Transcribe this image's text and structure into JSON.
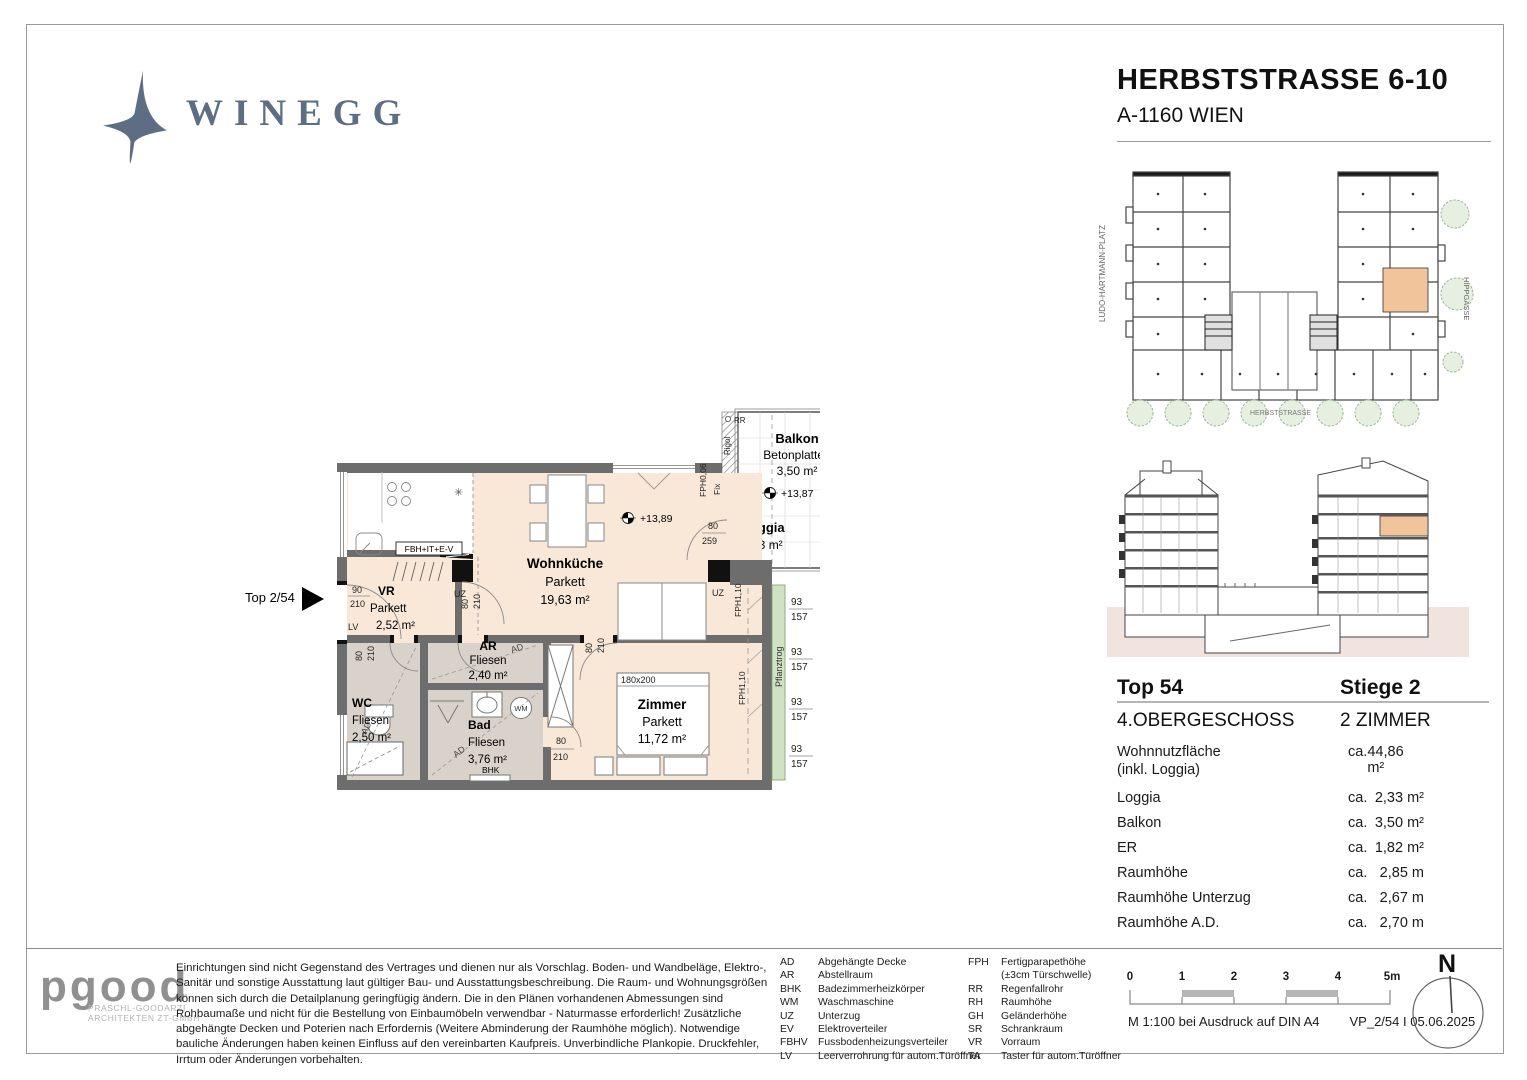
{
  "page": {
    "brand": "WINEGG",
    "title": "HERBSTSTRASSE 6-10",
    "subtitle": "A-1160 WIEN"
  },
  "floorplan": {
    "unit_arrow": "Top 2/54",
    "rooms": {
      "vr": {
        "name": "VR",
        "floor": "Parkett",
        "area": "2,52 m²"
      },
      "wohnkueche": {
        "name": "Wohnküche",
        "floor": "Parkett",
        "area": "19,63 m²"
      },
      "wc": {
        "name": "WC",
        "floor": "Fliesen",
        "area": "2,50 m²"
      },
      "ar": {
        "name": "AR",
        "floor": "Fliesen",
        "area": "2,40 m²"
      },
      "bad": {
        "name": "Bad",
        "floor": "Fliesen",
        "area": "3,76 m²"
      },
      "zimmer": {
        "name": "Zimmer",
        "floor": "Parkett",
        "area": "11,72 m²",
        "bed": "180x200"
      },
      "balkon": {
        "name": "Balkon",
        "floor": "Betonplatten",
        "area": "3,50 m²"
      },
      "loggia": {
        "name": "Loggia",
        "area": "2,33 m²"
      }
    },
    "annotations": {
      "fbh": "FBH+IT+E-V",
      "uz": "UZ",
      "lv": "LV",
      "wm": "WM",
      "bhk": "BHK",
      "ad": "AD",
      "rr": "RR",
      "rigol": "Rigol",
      "fix": "Fix",
      "fph0": "FPH0,06",
      "fph1": "FPH1,10",
      "gh": "GH= 112",
      "pflanztrog": "Pflanztrog",
      "elev_inside": "+13,89",
      "elev_balcony": "+13,87"
    },
    "dims": {
      "d75": "75",
      "d80": "80",
      "d90": "90",
      "d93": "93",
      "d157": "157",
      "d210": "210",
      "d259": "259",
      "d268": "268"
    }
  },
  "siteplan": {
    "street_left": "LUDO-HARTMANN-PLATZ",
    "street_bottom": "HERBSTSTRASSE",
    "street_right": "HIPPGASSE"
  },
  "unit_info": {
    "unit": "Top 54",
    "stair": "Stiege 2",
    "level": "4.OBERGESCHOSS",
    "room_count": "2 ZIMMER",
    "rows": [
      {
        "label": "Wohnnutzfläche",
        "sublabel": "(inkl. Loggia)",
        "ca": "ca.",
        "value": "44,86 m²"
      },
      {
        "label": "Loggia",
        "ca": "ca.",
        "value": "2,33 m²"
      },
      {
        "label": "Balkon",
        "ca": "ca.",
        "value": "3,50 m²"
      },
      {
        "label": "ER",
        "ca": "ca.",
        "value": "1,82 m²"
      },
      {
        "label": "Raumhöhe",
        "ca": "ca.",
        "value": "2,85 m"
      },
      {
        "label": "Raumhöhe Unterzug",
        "ca": "ca.",
        "value": "2,67 m"
      },
      {
        "label": "Raumhöhe A.D.",
        "ca": "ca.",
        "value": "2,70 m"
      }
    ]
  },
  "footer": {
    "architect": {
      "wordmark": "pgood",
      "sub1": "PRASCHL-GOODARZI",
      "sub2": "ARCHITEKTEN ZT-GMBH"
    },
    "disclaimer": "Einrichtungen sind nicht Gegenstand des Vertrages und dienen nur als Vorschlag. Boden- und Wandbeläge, Elektro-, Sanitär und sonstige Ausstattung laut gültiger Bau- und Ausstattungsbeschreibung. Die Raum- und Wohnungsgrößen können sich durch die Detailplanung geringfügig ändern. Die in den Plänen vorhandenen Abmessungen sind Rohbaumaße und nicht für die Bestellung von Einbaumöbeln verwendbar - Naturmasse erforderlich! Zusätzliche abgehängte Decken und Poterien nach Erfordernis (Weitere Abminderung der Raumhöhe möglich). Notwendige bauliche Änderungen haben keinen Einfluss auf den vereinbarten Kaufpreis. Unverbindliche Plankopie. Druckfehler, Irrtum oder Änderungen vorbehalten.",
    "legend_left": [
      {
        "abbr": "AD",
        "text": "Abgehängte Decke"
      },
      {
        "abbr": "AR",
        "text": "Abstellraum"
      },
      {
        "abbr": "BHK",
        "text": "Badezimmerheizkörper"
      },
      {
        "abbr": "WM",
        "text": "Waschmaschine"
      },
      {
        "abbr": "UZ",
        "text": "Unterzug"
      },
      {
        "abbr": "EV",
        "text": "Elektroverteiler"
      },
      {
        "abbr": "FBHV",
        "text": "Fussbodenheizungsverteiler"
      },
      {
        "abbr": "LV",
        "text": "Leerverrohrung für autom.Türöffner"
      }
    ],
    "legend_right": [
      {
        "abbr": "FPH",
        "text": "Fertigparapethöhe"
      },
      {
        "abbr": "",
        "text": "(±3cm Türschwelle)"
      },
      {
        "abbr": "RR",
        "text": "Regenfallrohr"
      },
      {
        "abbr": "RH",
        "text": "Raumhöhe"
      },
      {
        "abbr": "GH",
        "text": "Geländerhöhe"
      },
      {
        "abbr": "SR",
        "text": "Schrankraum"
      },
      {
        "abbr": "VR",
        "text": "Vorraum"
      },
      {
        "abbr": "TA",
        "text": "Taster für autom.Türöffner"
      }
    ],
    "scale": {
      "t0": "0",
      "t1": "1",
      "t2": "2",
      "t3": "3",
      "t4": "4",
      "t5": "5m",
      "note": "M 1:100 bei Ausdruck auf DIN A4",
      "plan_ref": "VP_2/54 I 05.06.2025"
    },
    "north_label": "N"
  },
  "colors": {
    "accent_unit": "#f2c49c",
    "floor_main": "#f9e8d8",
    "floor_wet": "#d9d2ca",
    "wall": "#6d6d6d",
    "planter": "#cfe3c3",
    "brand": "#5d6e84"
  }
}
